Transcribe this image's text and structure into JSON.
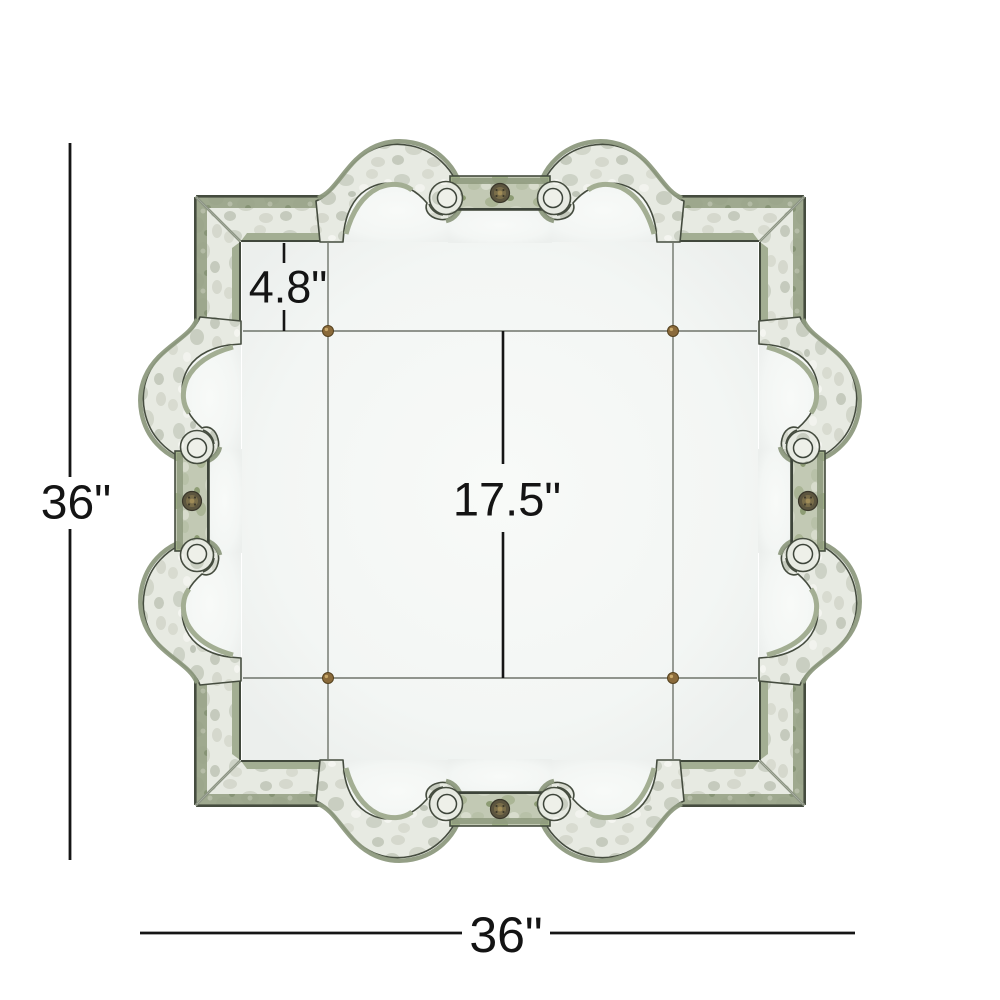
{
  "figure": {
    "type": "product-dimension-diagram",
    "subject": "ornate antiqued quatrefoil wall mirror with scrolled corners and rosette medallions",
    "labels": {
      "overall_height": "36\"",
      "overall_width": "36\"",
      "center_panel": "17.5\"",
      "border": "4.8\""
    },
    "colors": {
      "dimension_line": "#151515",
      "frame_mirror": "#e7eae2",
      "frame_moss": "#97a286",
      "frame_outline": "#454c3f",
      "glass": "#f4f6f3",
      "brass": "#8a6a3a"
    }
  }
}
